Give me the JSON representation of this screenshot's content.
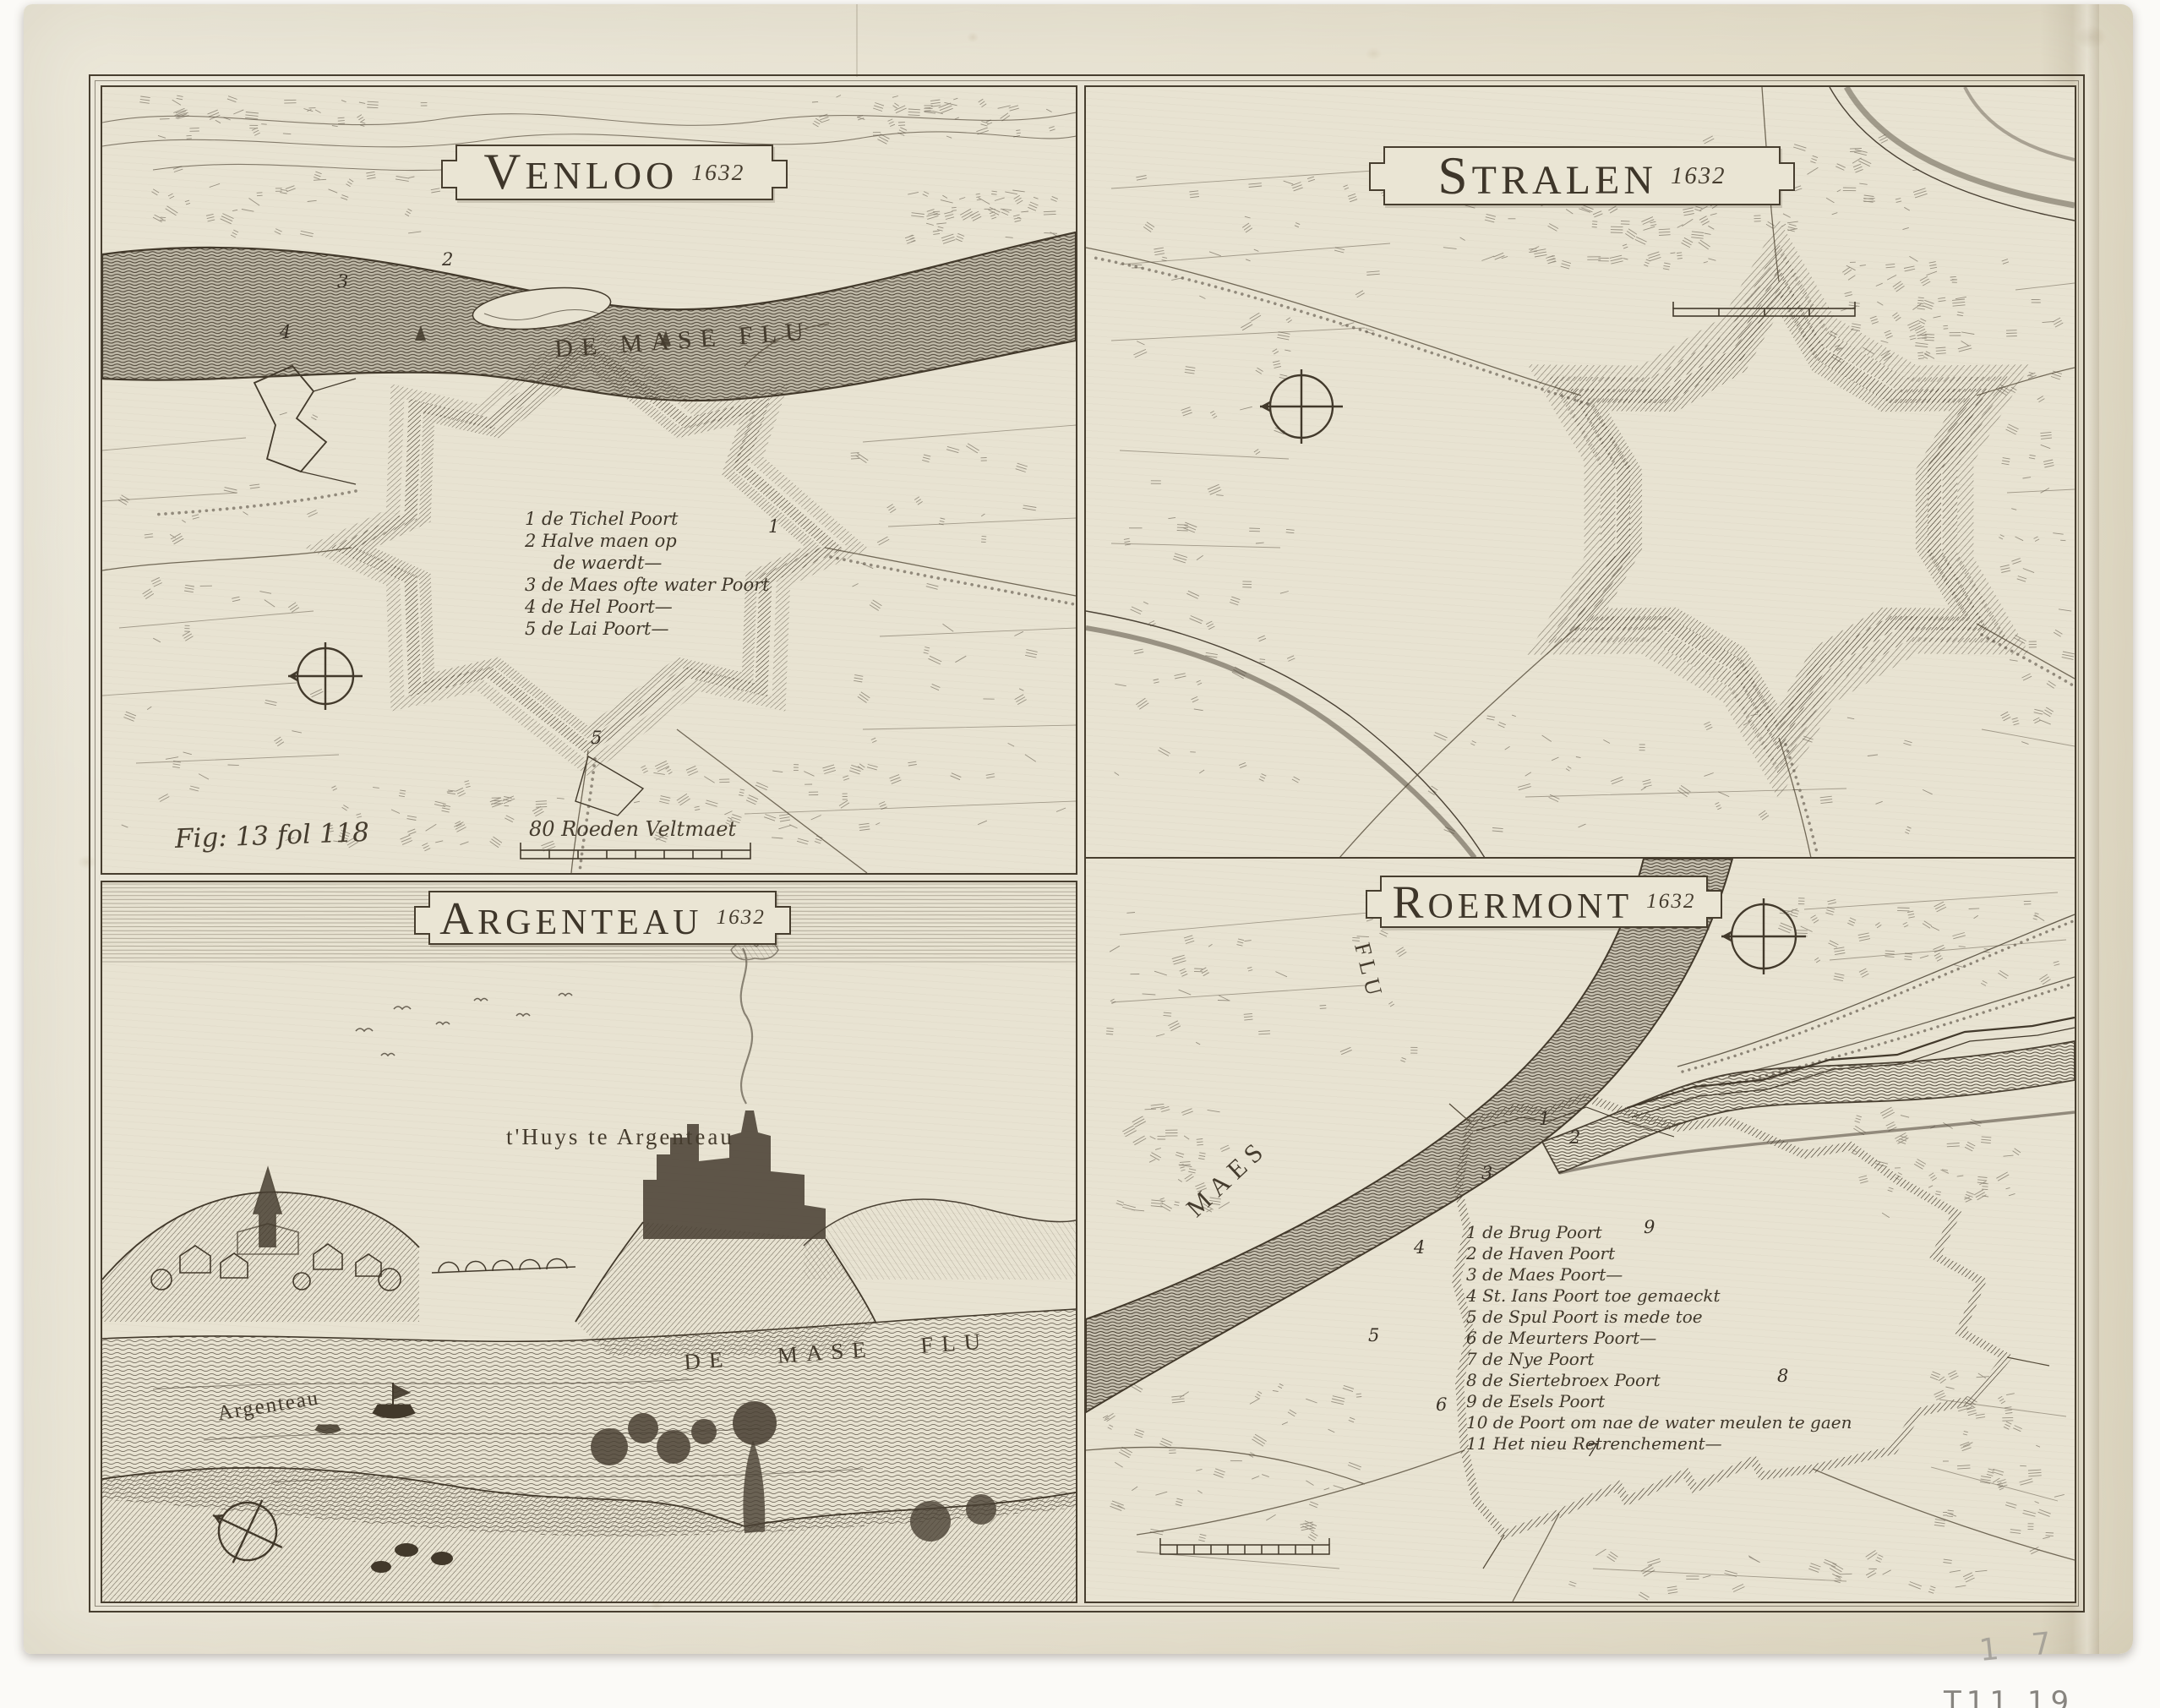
{
  "colors": {
    "paper": "#e8e3d2",
    "ink": "#42392b"
  },
  "plate": {
    "venloo": {
      "title": "Venloo",
      "year": "1632",
      "river_label": "DE MASE FLU",
      "legend": [
        "1 de Tichel Poort",
        "2 Halve maen op",
        "de waerdt—",
        "3 de Maes ofte water Poort",
        "4 de Hel Poort—",
        "5 de Lai Poort—"
      ],
      "fig_ref": "Fig: 13 fol 118",
      "scale_label": "80 Roeden Veltmaet",
      "gates": [
        "1",
        "2",
        "3",
        "4",
        "5"
      ]
    },
    "stralen": {
      "title": "Stralen",
      "year": "1632"
    },
    "argenteau": {
      "title": "Argenteau",
      "year": "1632",
      "house_label": "t'Huys te Argenteau",
      "village_label": "Argenteau",
      "river_label": "DE MASE FLU"
    },
    "roermont": {
      "title": "Roermont",
      "year": "1632",
      "river_label_1": "MAES",
      "river_label_2": "FLU",
      "legend": [
        "1 de Brug Poort",
        "2 de Haven Poort",
        "3 de Maes Poort—",
        "4 St. Ians Poort toe gemaeckt",
        "5 de Spul Poort is mede toe",
        "6 de Meurters Poort—",
        "7 de Nye Poort",
        "8 de Siertebroex Poort",
        "9 de Esels Poort",
        "10 de Poort om nae de water meulen te gaen",
        "11 Het nieu Retrenchement—"
      ],
      "gates": [
        "1",
        "2",
        "3",
        "4",
        "5",
        "6",
        "7",
        "8",
        "9"
      ]
    }
  },
  "annotations": {
    "pencil_note": "1 7",
    "pencil_note_2": "T11 19"
  }
}
